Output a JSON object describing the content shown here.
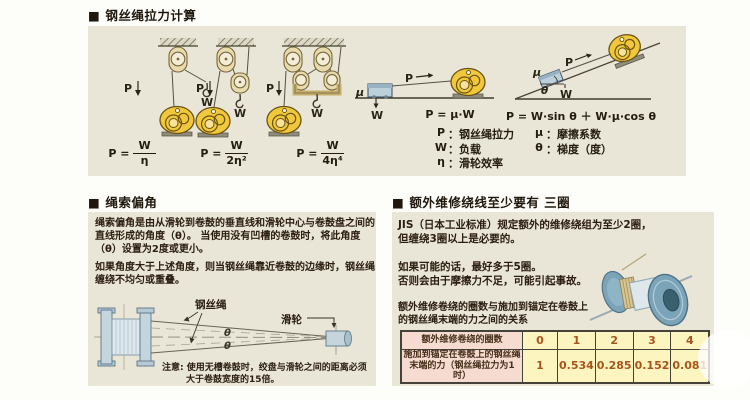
{
  "section1": {
    "title_bullet": "■",
    "title": "钢丝绳拉力计算",
    "labels": {
      "p": "P",
      "w": "W",
      "mu": "μ",
      "theta": "θ"
    },
    "formulas": [
      {
        "lhs": "P =",
        "num": "W",
        "den": "η"
      },
      {
        "lhs": "P =",
        "num": "W",
        "den": "2η²"
      },
      {
        "lhs": "P =",
        "num": "W",
        "den": "4η⁴"
      }
    ],
    "flat_formula": "P = μ·W",
    "incline_formula": "P = W·sin θ ＋ W·μ·cos θ",
    "legend_sep": "：",
    "legend": [
      {
        "symbol": "P",
        "text": "钢丝绳拉力"
      },
      {
        "symbol": "W",
        "text": "负载"
      },
      {
        "symbol": "η",
        "text": "滑轮效率"
      },
      {
        "symbol": "μ",
        "text": "摩擦系数"
      },
      {
        "symbol": "θ",
        "text": "梯度（度）"
      }
    ]
  },
  "section2": {
    "title_bullet": "■",
    "title": "绳索偏角",
    "para1_lines": [
      "绳索偏角是由从滑轮到卷鼓的垂直线和滑轮中心与卷鼓盘之间的",
      "直线形成的角度（θ）。 当使用没有凹槽的卷鼓时，将此角度",
      "（θ）设置为2度或更小。"
    ],
    "para2_lines": [
      "如果角度大于上述角度，则当钢丝绳靠近卷鼓的边缘时，钢丝绳",
      "缠绕不均匀或重叠。"
    ],
    "rope_label": "钢丝绳",
    "pulley_label": "滑轮",
    "theta": "θ",
    "note_lines": [
      "注意: 使用无槽卷鼓时，绞盘与滑轮之间的距离必须",
      "大于卷鼓宽度的15倍。"
    ]
  },
  "section3": {
    "title_bullet": "■",
    "title": "额外维修绕线至少要有 三圈",
    "para1_lines": [
      "JIS（日本工业标准）规定额外的维修绕组为至少2圈，",
      "但缠绕3圈以上是必要的。"
    ],
    "para2_lines": [
      "如果可能的话，最好多于5圈。",
      "否则会由于摩擦力不足，可能引起事故。"
    ],
    "para3_lines": [
      "额外维修卷绕的圈数与施加到锚定在卷鼓上",
      "的钢丝绳末端的力之间的关系"
    ],
    "table": {
      "row1_header": "额外维修卷绕的圈数",
      "row1_values": [
        "0",
        "1",
        "2",
        "3",
        "4"
      ],
      "row2_header_lines": [
        "施加到锚定在卷鼓上的钢丝绳",
        "末端的力（钢丝绳拉力为1时）"
      ],
      "row2_values": [
        "1",
        "0.534",
        "0.285",
        "0.152",
        "0.081"
      ]
    }
  }
}
